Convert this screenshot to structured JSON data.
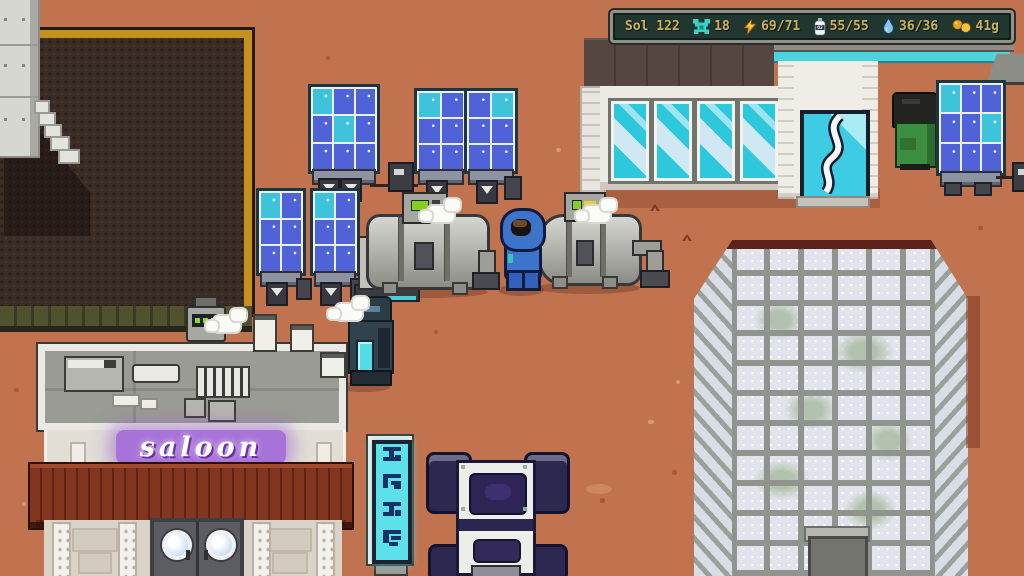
{
  "hud": {
    "sol": "Sol 122",
    "stats": [
      {
        "id": "nanites",
        "icon": "nanite-icon",
        "value": "18",
        "color": "#38d2c6"
      },
      {
        "id": "energy",
        "icon": "energy-bolt-icon",
        "value": "69/71",
        "color": "#e89b25"
      },
      {
        "id": "oxygen",
        "icon": "oxygen-tank-icon",
        "icon_label": "O2",
        "value": "55/55",
        "color": "#eef1f5"
      },
      {
        "id": "water",
        "icon": "water-drop-icon",
        "value": "36/36",
        "color": "#84c6f0"
      },
      {
        "id": "money",
        "icon": "coins-icon",
        "value": "41g",
        "color": "#e6a426"
      }
    ],
    "text_color": "#cdb061",
    "panel_color": "#20362e"
  },
  "scene": {
    "saloon_sign": "saloon",
    "ground_color": "#c1734f",
    "field_border_color": "#c2921d",
    "neon_purple": "#9e64d8",
    "window_cyan": "#2ec8dc",
    "objects": [
      "farm-plot",
      "metal-tower",
      "solar-panel-array",
      "habitat-building",
      "glass-door",
      "green-dumpster",
      "oxygen-tank-machines",
      "steam-puffs",
      "player-character",
      "service-robot",
      "vaporator-droid",
      "saloon-building",
      "neon-pole-sign",
      "rover-vehicle",
      "greenhouse-tower"
    ]
  }
}
